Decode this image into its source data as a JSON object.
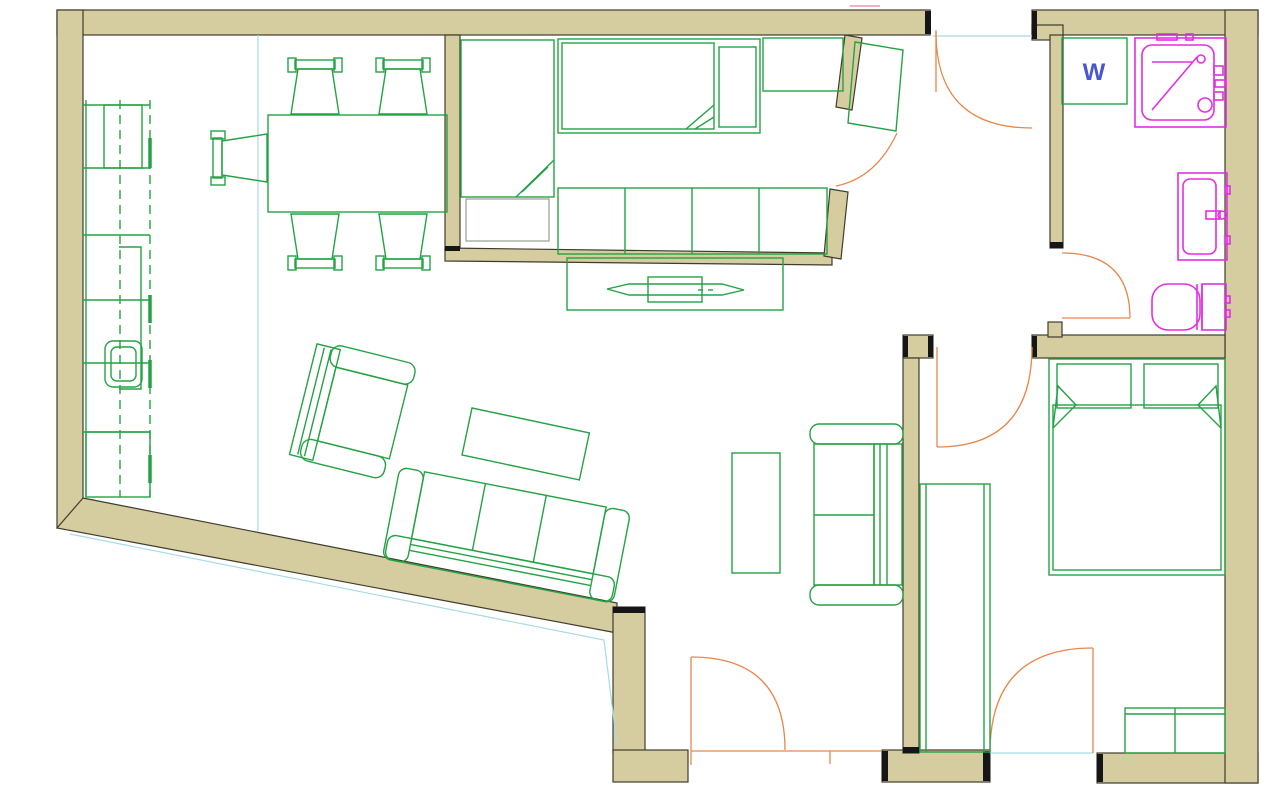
{
  "page": {
    "title": "Apartment floor plan drawing",
    "background": "#ffffff"
  },
  "labels": {
    "washer": "W"
  },
  "colors": {
    "wall_fill": "#d5cc9f",
    "wall_stroke": "#3f3c2e",
    "cap_color": "#161616",
    "furniture_color": "#25a244",
    "pillow_gray": "#9aa79b",
    "door_color": "#e8874b",
    "fixture_color": "#e22fe2",
    "guide_color": "#a5dce5",
    "washer_label_color": "#4956cc"
  },
  "semantics": {
    "rooms": [
      "kitchen-living-dining",
      "bedroom-small",
      "entry-hall",
      "bathroom",
      "bedroom-main"
    ],
    "furniture": [
      "kitchen-counter",
      "kitchen-sink",
      "dining-table",
      "dining-chair",
      "single-bed-vertical",
      "single-bed-horizontal",
      "wardrobe",
      "wall-shelf",
      "tv-bench",
      "tv",
      "armchair",
      "coffee-table",
      "sofa-three-seat",
      "loveseat",
      "side-table",
      "double-bed",
      "closet",
      "dresser",
      "washing-machine",
      "shower",
      "bathroom-sink",
      "toilet"
    ],
    "doors": [
      "entry-top-door",
      "bedroom-small-door",
      "bathroom-door",
      "bedroom-main-door",
      "entry-bottom-door",
      "bedroom-main-second-door"
    ]
  }
}
